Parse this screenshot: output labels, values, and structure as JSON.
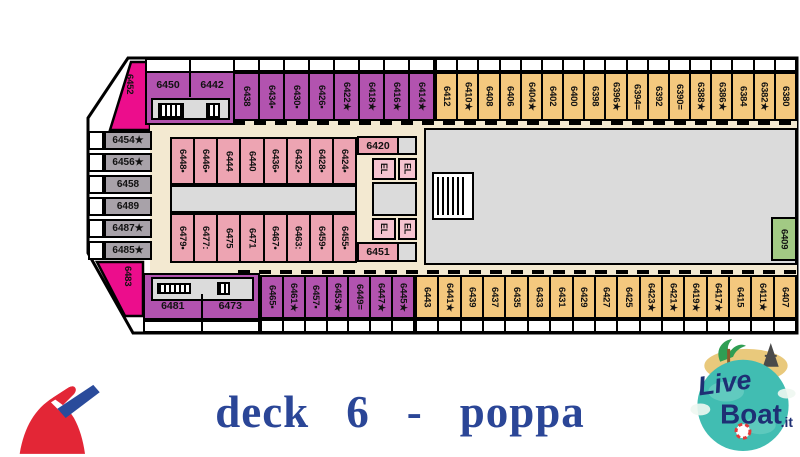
{
  "title": "deck 6 - poppa",
  "colors": {
    "purple": "#b253af",
    "pink": "#eda4b2",
    "pink_light": "#f5c3d0",
    "orange": "#f4c87e",
    "gray_cabin": "#a8a2a9",
    "gray_open": "#dbdbdb",
    "corridor_beige": "#f3e9d1",
    "magenta": "#ec0d8c",
    "green": "#a2ca84",
    "title_blue": "#2b4697"
  },
  "deck": {
    "elevator_label": "EL",
    "stern_cabin_top": "6452",
    "stern_cabin_bottom": "6483",
    "aft_block_top": [
      "6450",
      "6442"
    ],
    "aft_block_bottom": [
      "6481",
      "6473"
    ],
    "left_column": [
      "6454★",
      "6456★",
      "6458",
      "6489",
      "6487★",
      "6485★"
    ],
    "top_row_purple": [
      "6438",
      "6434▪",
      "6430▪",
      "6426▪",
      "6422★",
      "6418★",
      "6416★",
      "6414★"
    ],
    "top_row_orange": [
      "6412",
      "6410★",
      "6408",
      "6406",
      "6404★",
      "6402",
      "6400",
      "6398",
      "6396★",
      "6394=",
      "6392",
      "6390=",
      "6388★",
      "6386★",
      "6384",
      "6382★",
      "6380"
    ],
    "mid_upper_pink": [
      "6448•",
      "6446•",
      "6444",
      "6440",
      "6436•",
      "6432•",
      "6428•",
      "6424•"
    ],
    "mid_lower_pink": [
      "6479•",
      "6477:",
      "6475",
      "6471",
      "6467•",
      "6463:",
      "6459•",
      "6455•"
    ],
    "cabin_6420": "6420",
    "cabin_6451": "6451",
    "cabin_6409": "6409",
    "bottom_row_purple": [
      "6469★",
      "6465▪",
      "6461★",
      "6457▪",
      "6453★",
      "6449=",
      "6447★",
      "6445★"
    ],
    "bottom_row_orange": [
      "6443",
      "6441★",
      "6439",
      "6437",
      "6435",
      "6433",
      "6431",
      "6429",
      "6427",
      "6425",
      "6423★",
      "6421★",
      "6419★",
      "6417★",
      "6415",
      "6411★",
      "6407"
    ]
  },
  "logo": {
    "live": "Live",
    "boat": "Boat",
    "it": ".it"
  }
}
